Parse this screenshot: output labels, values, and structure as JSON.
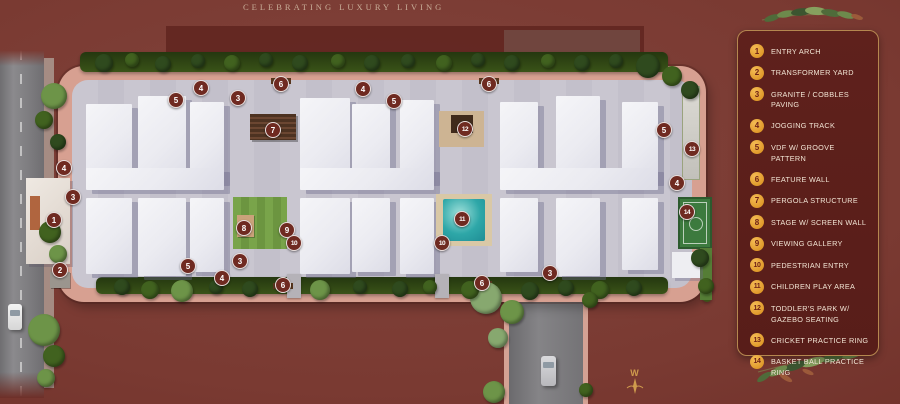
{
  "title": "CELEBRATING LUXURY LIVING",
  "compass": {
    "label": "W"
  },
  "colors": {
    "background": "#7a3a32",
    "legend_panel": "#5f211c",
    "legend_border": "#b5874f",
    "legend_badge": "#e09a2b",
    "legend_badge_number": "#6d1f15",
    "legend_text": "#f2e4d4",
    "plan_marker": "#6f2a21",
    "plan_marker_text": "#ffffff",
    "pool_water": "#2ea7a8",
    "track_paving": "#d7a091",
    "hedge_green": "#2f4716"
  },
  "legend": {
    "items": [
      {
        "num": "1",
        "label": "ENTRY ARCH"
      },
      {
        "num": "2",
        "label": "TRANSFORMER YARD"
      },
      {
        "num": "3",
        "label": "GRANITE / COBBLES PAVING"
      },
      {
        "num": "4",
        "label": "JOGGING TRACK"
      },
      {
        "num": "5",
        "label": "VDF W/ GROOVE PATTERN"
      },
      {
        "num": "6",
        "label": "FEATURE WALL"
      },
      {
        "num": "7",
        "label": "PERGOLA STRUCTURE"
      },
      {
        "num": "8",
        "label": "STAGE W/ SCREEN WALL"
      },
      {
        "num": "9",
        "label": "VIEWING GALLERY"
      },
      {
        "num": "10",
        "label": "PEDESTRIAN ENTRY"
      },
      {
        "num": "11",
        "label": "CHILDREN PLAY AREA"
      },
      {
        "num": "12",
        "label": "TODDLER'S PARK W/ GAZEBO SEATING"
      },
      {
        "num": "13",
        "label": "CRICKET PRACTICE RING"
      },
      {
        "num": "14",
        "label": "BASKET BALL PRACTICE RING"
      }
    ]
  },
  "plan": {
    "markers": [
      {
        "n": "4",
        "x": 64,
        "y": 168
      },
      {
        "n": "3",
        "x": 73,
        "y": 197
      },
      {
        "n": "1",
        "x": 54,
        "y": 220
      },
      {
        "n": "2",
        "x": 60,
        "y": 270
      },
      {
        "n": "5",
        "x": 176,
        "y": 100
      },
      {
        "n": "4",
        "x": 201,
        "y": 88
      },
      {
        "n": "3",
        "x": 238,
        "y": 98
      },
      {
        "n": "6",
        "x": 281,
        "y": 84
      },
      {
        "n": "7",
        "x": 273,
        "y": 130
      },
      {
        "n": "4",
        "x": 363,
        "y": 89
      },
      {
        "n": "5",
        "x": 394,
        "y": 101
      },
      {
        "n": "12",
        "x": 465,
        "y": 129
      },
      {
        "n": "6",
        "x": 489,
        "y": 84
      },
      {
        "n": "5",
        "x": 664,
        "y": 130
      },
      {
        "n": "13",
        "x": 692,
        "y": 149
      },
      {
        "n": "4",
        "x": 677,
        "y": 183
      },
      {
        "n": "14",
        "x": 687,
        "y": 212
      },
      {
        "n": "8",
        "x": 244,
        "y": 228
      },
      {
        "n": "9",
        "x": 287,
        "y": 230
      },
      {
        "n": "10",
        "x": 294,
        "y": 243
      },
      {
        "n": "11",
        "x": 462,
        "y": 219
      },
      {
        "n": "10",
        "x": 442,
        "y": 243
      },
      {
        "n": "5",
        "x": 188,
        "y": 266
      },
      {
        "n": "3",
        "x": 240,
        "y": 261
      },
      {
        "n": "4",
        "x": 222,
        "y": 278
      },
      {
        "n": "6",
        "x": 283,
        "y": 285
      },
      {
        "n": "6",
        "x": 482,
        "y": 283
      },
      {
        "n": "3",
        "x": 550,
        "y": 273
      }
    ],
    "buildings": [
      {
        "x": 86,
        "y": 104,
        "w": 46,
        "h": 80
      },
      {
        "x": 138,
        "y": 96,
        "w": 48,
        "h": 88
      },
      {
        "x": 190,
        "y": 102,
        "w": 34,
        "h": 80
      },
      {
        "x": 300,
        "y": 98,
        "w": 50,
        "h": 86
      },
      {
        "x": 352,
        "y": 104,
        "w": 38,
        "h": 80
      },
      {
        "x": 400,
        "y": 100,
        "w": 34,
        "h": 82
      },
      {
        "x": 500,
        "y": 102,
        "w": 38,
        "h": 82
      },
      {
        "x": 556,
        "y": 96,
        "w": 44,
        "h": 88
      },
      {
        "x": 622,
        "y": 102,
        "w": 36,
        "h": 80
      },
      {
        "x": 86,
        "y": 168,
        "w": 138,
        "h": 22
      },
      {
        "x": 300,
        "y": 168,
        "w": 134,
        "h": 22
      },
      {
        "x": 500,
        "y": 168,
        "w": 158,
        "h": 22
      },
      {
        "x": 86,
        "y": 198,
        "w": 46,
        "h": 76
      },
      {
        "x": 138,
        "y": 198,
        "w": 48,
        "h": 78
      },
      {
        "x": 190,
        "y": 198,
        "w": 34,
        "h": 74
      },
      {
        "x": 300,
        "y": 198,
        "w": 50,
        "h": 76
      },
      {
        "x": 352,
        "y": 198,
        "w": 38,
        "h": 74
      },
      {
        "x": 400,
        "y": 198,
        "w": 34,
        "h": 76
      },
      {
        "x": 500,
        "y": 198,
        "w": 38,
        "h": 74
      },
      {
        "x": 556,
        "y": 198,
        "w": 44,
        "h": 78
      },
      {
        "x": 622,
        "y": 198,
        "w": 36,
        "h": 72
      }
    ],
    "tree_colors": {
      "d": "#2f4a1e",
      "m": "#41621f",
      "l": "#6d9448",
      "s": "#87a86f"
    },
    "trees": [
      {
        "x": 104,
        "y": 63,
        "r": 9,
        "c": "d"
      },
      {
        "x": 132,
        "y": 60,
        "r": 7,
        "c": "m"
      },
      {
        "x": 163,
        "y": 64,
        "r": 8,
        "c": "d"
      },
      {
        "x": 198,
        "y": 61,
        "r": 7,
        "c": "d"
      },
      {
        "x": 232,
        "y": 63,
        "r": 8,
        "c": "m"
      },
      {
        "x": 266,
        "y": 60,
        "r": 7,
        "c": "d"
      },
      {
        "x": 300,
        "y": 63,
        "r": 8,
        "c": "d"
      },
      {
        "x": 338,
        "y": 61,
        "r": 7,
        "c": "m"
      },
      {
        "x": 372,
        "y": 63,
        "r": 8,
        "c": "d"
      },
      {
        "x": 408,
        "y": 61,
        "r": 7,
        "c": "d"
      },
      {
        "x": 444,
        "y": 63,
        "r": 8,
        "c": "m"
      },
      {
        "x": 478,
        "y": 60,
        "r": 7,
        "c": "d"
      },
      {
        "x": 512,
        "y": 63,
        "r": 8,
        "c": "d"
      },
      {
        "x": 548,
        "y": 61,
        "r": 7,
        "c": "m"
      },
      {
        "x": 582,
        "y": 63,
        "r": 8,
        "c": "d"
      },
      {
        "x": 616,
        "y": 61,
        "r": 7,
        "c": "d"
      },
      {
        "x": 648,
        "y": 66,
        "r": 12,
        "c": "d"
      },
      {
        "x": 672,
        "y": 76,
        "r": 10,
        "c": "m"
      },
      {
        "x": 690,
        "y": 90,
        "r": 9,
        "c": "d"
      },
      {
        "x": 122,
        "y": 287,
        "r": 8,
        "c": "d"
      },
      {
        "x": 150,
        "y": 290,
        "r": 9,
        "c": "m"
      },
      {
        "x": 182,
        "y": 291,
        "r": 11,
        "c": "l"
      },
      {
        "x": 216,
        "y": 287,
        "r": 7,
        "c": "d"
      },
      {
        "x": 250,
        "y": 289,
        "r": 8,
        "c": "d"
      },
      {
        "x": 320,
        "y": 290,
        "r": 10,
        "c": "l"
      },
      {
        "x": 360,
        "y": 287,
        "r": 7,
        "c": "d"
      },
      {
        "x": 400,
        "y": 289,
        "r": 8,
        "c": "d"
      },
      {
        "x": 430,
        "y": 287,
        "r": 7,
        "c": "m"
      },
      {
        "x": 530,
        "y": 291,
        "r": 9,
        "c": "d"
      },
      {
        "x": 566,
        "y": 288,
        "r": 8,
        "c": "d"
      },
      {
        "x": 600,
        "y": 290,
        "r": 9,
        "c": "m"
      },
      {
        "x": 634,
        "y": 288,
        "r": 8,
        "c": "d"
      },
      {
        "x": 486,
        "y": 298,
        "r": 16,
        "c": "s"
      },
      {
        "x": 512,
        "y": 312,
        "r": 12,
        "c": "l"
      },
      {
        "x": 470,
        "y": 290,
        "r": 9,
        "c": "m"
      },
      {
        "x": 54,
        "y": 96,
        "r": 13,
        "c": "l"
      },
      {
        "x": 44,
        "y": 120,
        "r": 9,
        "c": "m"
      },
      {
        "x": 58,
        "y": 142,
        "r": 8,
        "c": "d"
      },
      {
        "x": 50,
        "y": 232,
        "r": 11,
        "c": "m"
      },
      {
        "x": 58,
        "y": 254,
        "r": 9,
        "c": "l"
      },
      {
        "x": 44,
        "y": 330,
        "r": 16,
        "c": "l"
      },
      {
        "x": 54,
        "y": 356,
        "r": 11,
        "c": "m"
      },
      {
        "x": 46,
        "y": 378,
        "r": 9,
        "c": "l"
      },
      {
        "x": 498,
        "y": 338,
        "r": 10,
        "c": "s"
      },
      {
        "x": 590,
        "y": 300,
        "r": 8,
        "c": "m"
      },
      {
        "x": 494,
        "y": 392,
        "r": 11,
        "c": "l"
      },
      {
        "x": 586,
        "y": 390,
        "r": 7,
        "c": "m"
      },
      {
        "x": 700,
        "y": 258,
        "r": 9,
        "c": "d"
      },
      {
        "x": 706,
        "y": 286,
        "r": 8,
        "c": "m"
      }
    ]
  }
}
